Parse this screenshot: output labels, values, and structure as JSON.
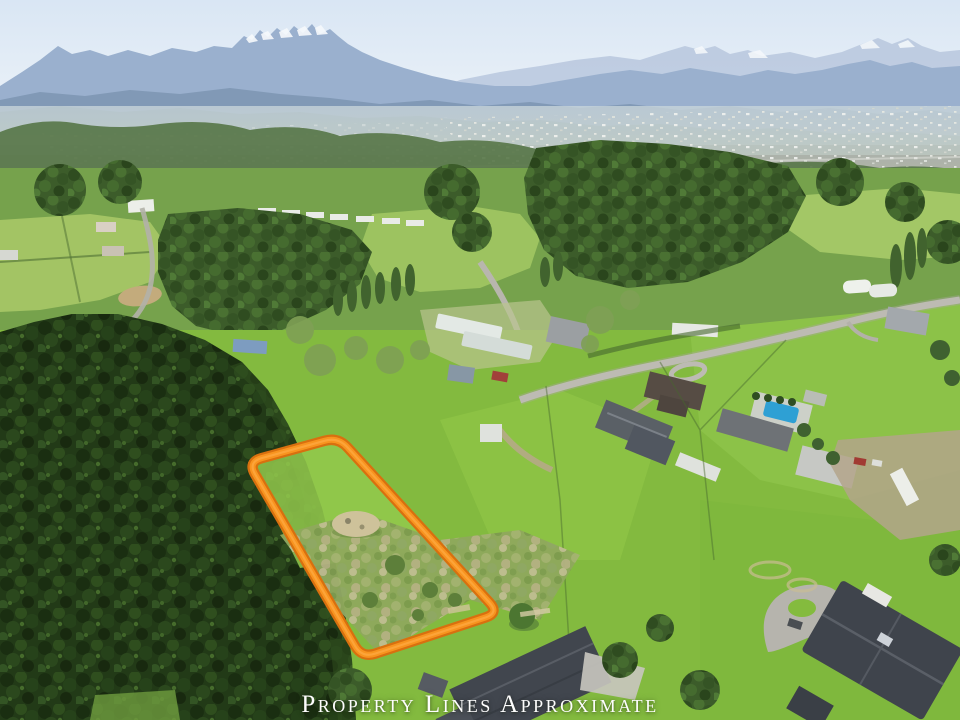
{
  "overlay": {
    "caption": "Property Lines Approximate",
    "caption_color": "#fdfdfd",
    "property_outline": {
      "path": "M261.5,458.2 L324.5,440.8 Q338,437 347.4,447.3 L489.6,602.7 Q499,613 485.7,617.4 L375.3,653.6 Q362,658 355,645.9 L255,474.1 Q248,462 261.5,458.2 Z",
      "stroke_outer": "#d8700f",
      "stroke_inner": "#f8941f",
      "stroke_highlight": "#ffb14e"
    }
  },
  "scene": {
    "description": "Aerial drone photo of a rural vacant lot outlined in orange; dense conifer forest at left, bright green pastures, country homes with swimming pool and greenhouses, a distant town in the valley and hazy snow-capped mountains under a pale spring sky.",
    "palette": {
      "sky": "#e2ecf6",
      "mountains_far": "#bac9df",
      "mountains_main": "#9ab0ce",
      "valley_haze": "#cfd8d4",
      "forest_dark": "#223a17",
      "forest_mid": "#3c5c2a",
      "grass": "#84bb3e",
      "scrub": "#8fa85c",
      "road": "#bdbbb3",
      "roof_dark": "#41464e",
      "pool": "#2ea0d4",
      "snow": "#f6f9fc"
    }
  }
}
